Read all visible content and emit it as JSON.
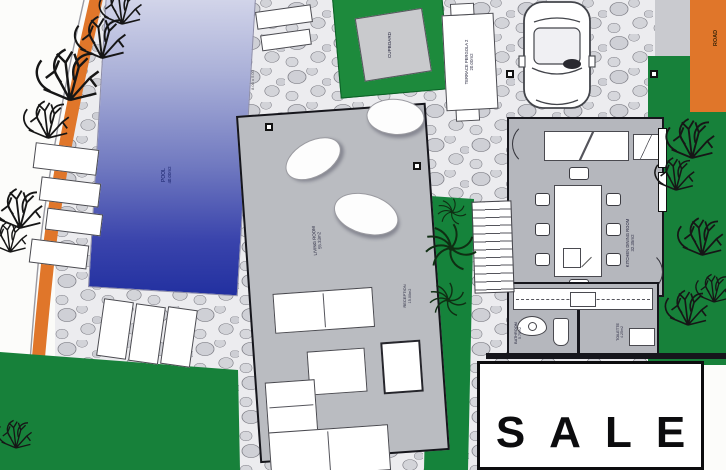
{
  "plan": {
    "rooms": {
      "pool": {
        "label": "POOL",
        "area": "40.00m2"
      },
      "living_room": {
        "label": "LIVING ROOM",
        "area": "55.33m2"
      },
      "kitchen_dining": {
        "label": "KITCHEN DINING ROOM",
        "area": "32.35m2"
      },
      "reception": {
        "label": "RECEPTION",
        "area": "15.00m2"
      },
      "bathroom": {
        "label": "BATHROOM",
        "area": "5.70m2"
      },
      "toilette": {
        "label": "TOILETTE",
        "area": "4.25m2"
      },
      "cupboard": {
        "label": "CUPBOARD"
      },
      "terrace_pergola": {
        "label": "TERRACE PERGOLA 2",
        "area": "20.00m2"
      },
      "driveway": {
        "label": "DRIVEWAY"
      },
      "road": {
        "label": "ROAD"
      }
    },
    "annotations": {
      "pool_dimension": "8.00 x 5.00"
    },
    "sale_sign": {
      "text": "SALE"
    },
    "colors": {
      "lawn": "#17813a",
      "pool_deep": "#2230a0",
      "pool_light": "#d4d7ea",
      "path_orange": "#e0762a",
      "floor_gray": "#b5b7bd",
      "stone_gray": "#d0d1d6"
    }
  }
}
